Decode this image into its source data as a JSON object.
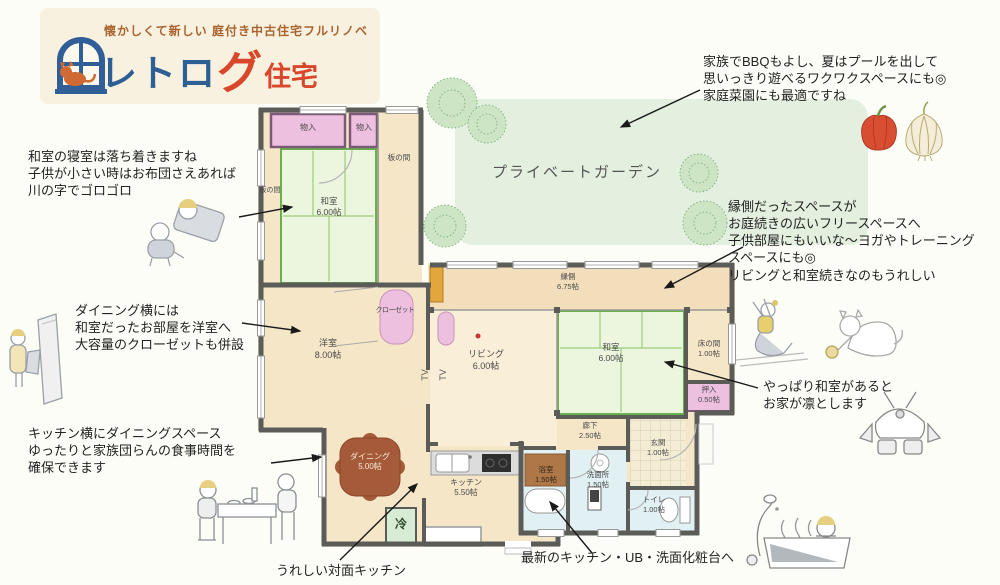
{
  "logo": {
    "tagline": "懐かしくて新しい 庭付き中古住宅フルリノベ",
    "name_blue": "レトロ",
    "name_red_big": "グ",
    "name_red": "住宅"
  },
  "garden": {
    "label": "プライベートガーデン"
  },
  "rooms": {
    "monoire1": {
      "label": "物入"
    },
    "monoire2": {
      "label": "物入"
    },
    "itanoma_right": {
      "label": "板の間"
    },
    "itanoma_left": {
      "label": "板の間"
    },
    "washitsu_nw": {
      "label": "和室",
      "size": "6.00帖"
    },
    "yoshitsu": {
      "label": "洋室",
      "size": "8.00帖"
    },
    "closet": {
      "label": "クローゼット"
    },
    "engawa": {
      "label": "縁側",
      "size": "6.75帖"
    },
    "living": {
      "label": "リビング",
      "size": "6.00帖"
    },
    "washitsu_e": {
      "label": "和室",
      "size": "6.00帖"
    },
    "tokonoma": {
      "label": "床の間",
      "size": "1.00帖"
    },
    "oshiire": {
      "label": "押入",
      "size": "0.50帖"
    },
    "dining": {
      "label": "ダイニング",
      "size": "5.00帖"
    },
    "kitchen": {
      "label": "キッチン",
      "size": "5.50帖"
    },
    "bath": {
      "label": "浴室",
      "size": "1.50帖"
    },
    "senmen": {
      "label": "洗面所",
      "size": "1.50帖"
    },
    "rouka": {
      "label": "廊下",
      "size": "2.50帖"
    },
    "genkan": {
      "label": "玄関",
      "size": "1.00帖"
    },
    "toilet": {
      "label": "トイレ",
      "size": "1.00帖"
    },
    "fridge": {
      "label": "冷"
    },
    "tv": {
      "label": "TV"
    }
  },
  "notes": {
    "garden_bbq": "家族でBBQもよし、夏はプールを出して\n思いっきり遊べるワクワクスペースにも◎\n家庭菜園にも最適ですね",
    "washitsu_sleep": "和室の寝室は落ち着きますね\n子供が小さい時はお布団さえあれば\n川の字でゴロゴロ",
    "dining_side": "ダイニング横には\n和室だったお部屋を洋室へ\n大容量のクローゼットも併設",
    "kitchen_dining": "キッチン横にダイニングスペース\nゆったりと家族団らんの食事時間を\n確保できます",
    "engawa_free": "縁側だったスペースが\nお庭続きの広いフリースペースへ\n子供部屋にもいいな～ヨガやトレーニング\nスペースにも◎\nリビングと和室続きなのもうれしい",
    "washitsu_dignity": "やっぱり和室があると\nお家が凛とします",
    "counter_kitchen": "うれしい対面キッチン",
    "renewed": "最新のキッチン・UB・洗面化粧台へ"
  },
  "colors": {
    "logo_blue": "#2e5f94",
    "logo_red": "#d9472b",
    "wall": "#5b5b58",
    "tatami_border": "#6ab04a",
    "storage_pink": "#eec0e0",
    "garden_green": "#e3efdf",
    "floor_beige": "#f5e6c8"
  },
  "illustrations": [
    "window-cat-logo-icon",
    "sleeping-children",
    "mirror-closet-person",
    "dining-family",
    "bell-pepper",
    "garlic",
    "garden-bushes",
    "yoga-person",
    "cat-with-ball",
    "samurai-helmet",
    "person-in-bathtub",
    "dining-table",
    "refrigerator",
    "bathtub",
    "toilet",
    "wash-basin",
    "kitchen-sink",
    "gas-stove"
  ]
}
